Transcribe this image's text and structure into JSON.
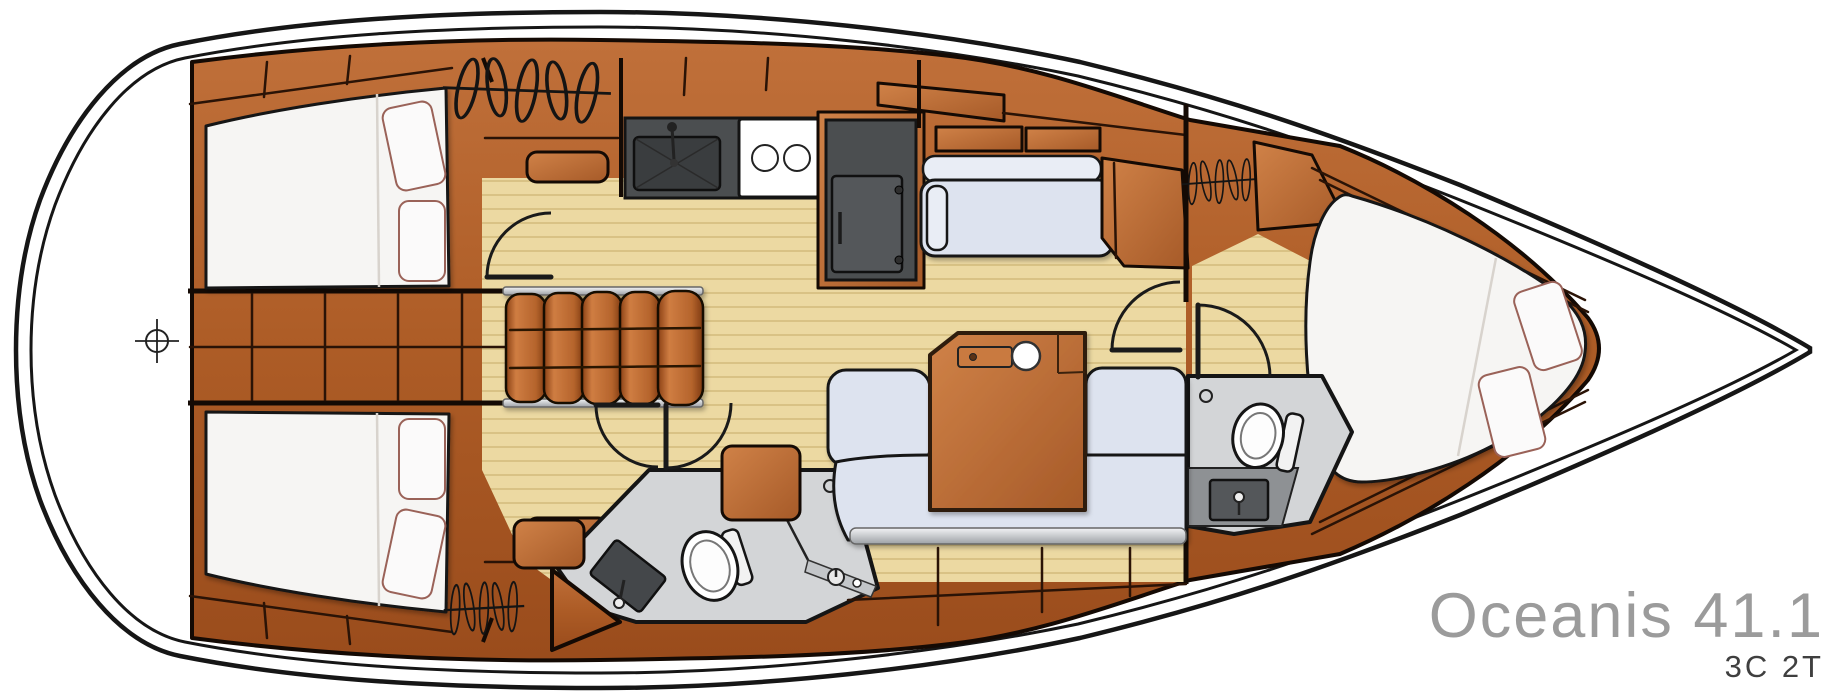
{
  "title": {
    "model": "Oceanis 41.1",
    "layout_code": "3C 2T"
  },
  "colors": {
    "hull_line": "#161616",
    "wood": "#b5672f",
    "wood_dark": "#8d4418",
    "wood_line": "#2a1306",
    "floor": "#ecd9a2",
    "plank_line": "#d9c285",
    "cushion": "#dde3ef",
    "cushion_light": "#e9edf5",
    "bed": "#f6f5f3",
    "pillow_edge": "#9a6258",
    "head_floor": "#d3d5d7",
    "counter_dark": "#4b4e50",
    "metal": "#c9ccd1",
    "title_text": "#9b9b9b",
    "code_text": "#3f3f3f"
  },
  "icons": {
    "hanger": "clothes-hanger rod symbol",
    "helm": "crosshair circle",
    "toilet": "oval bowl with tank",
    "sink": "dark basin with faucet",
    "stove": "two burner rings",
    "fridge": "dark door with hinges",
    "cupholder": "white circle",
    "shower_mixer": "circle with lever"
  }
}
